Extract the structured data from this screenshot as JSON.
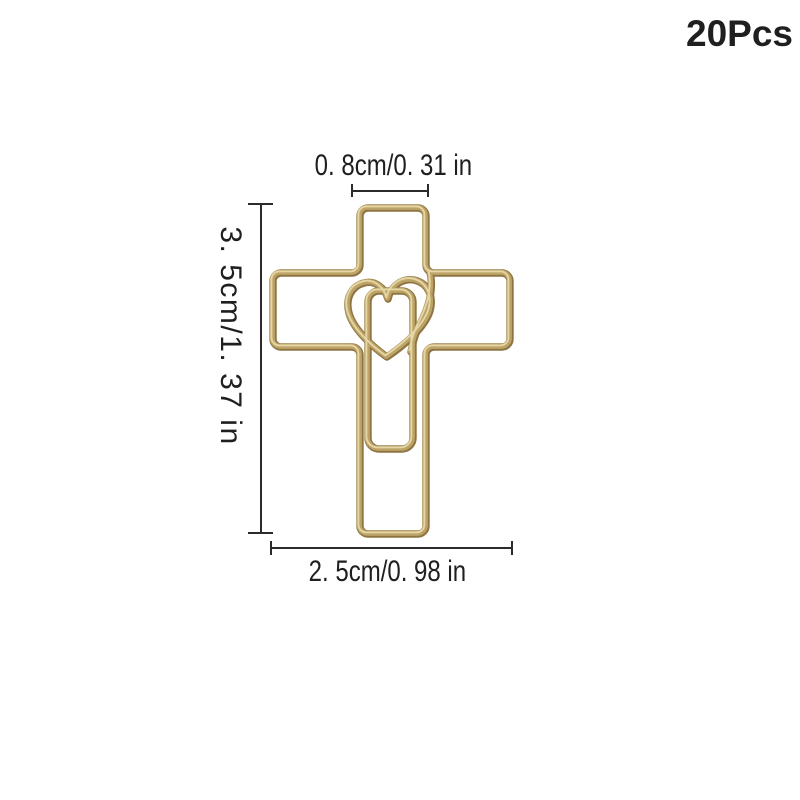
{
  "product": {
    "quantity_label": "20Pcs"
  },
  "dimensions": {
    "top_width": {
      "label": "0. 8cm/0. 31 in"
    },
    "side_height": {
      "label": "3. 5cm/1. 37 in"
    },
    "bottom_width": {
      "label": "2. 5cm/0. 98 in"
    }
  },
  "colors": {
    "background": "#ffffff",
    "text-color": "#1f1f1f",
    "line-color": "#2b2b2b",
    "gold-dark": "#8e7440",
    "gold-mid": "#bca368",
    "gold-light": "#e8d9a8"
  }
}
